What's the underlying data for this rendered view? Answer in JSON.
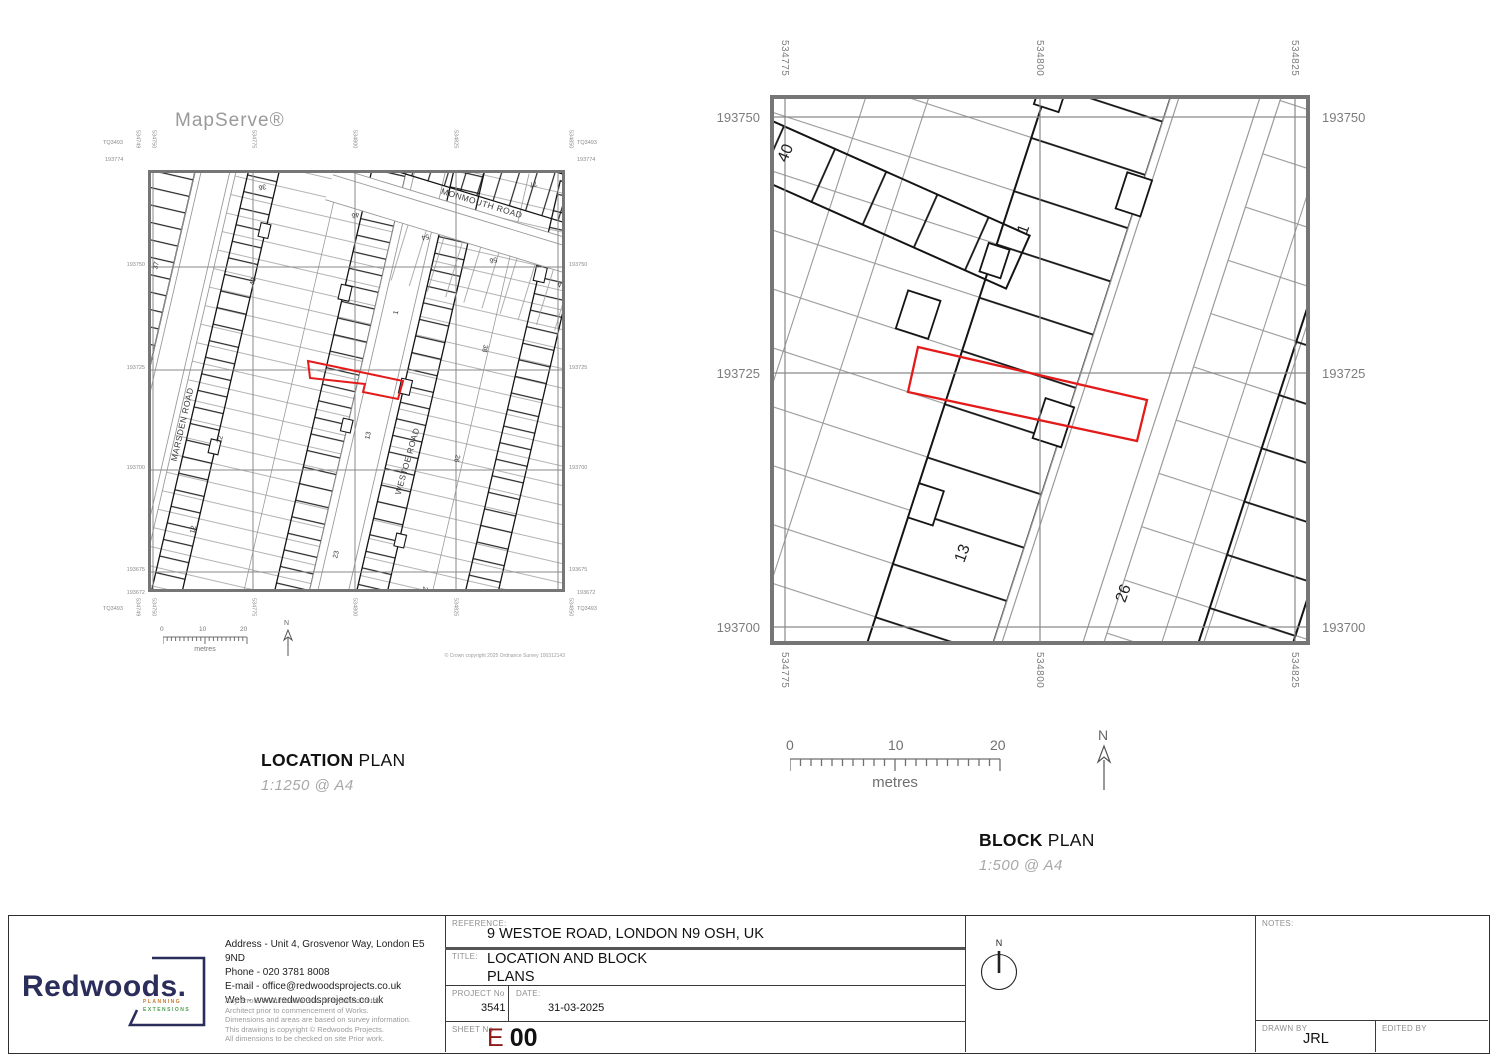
{
  "location_plan": {
    "provider": "MapServe®",
    "caption": {
      "bold": "LOCATION",
      "rest": "PLAN",
      "scale": "1:1250 @ A4"
    },
    "copyright": "© Crown copyright 2025 Ordnance Survey 100312143",
    "scalebar": {
      "zero": "0",
      "ten": "10",
      "twenty": "20",
      "unit": "metres"
    },
    "north": "N",
    "corner_ref": "TQ3493",
    "top_northing": "193774",
    "bottom_northing": "193672",
    "left_easting": "534749",
    "right_easting": "534850",
    "eastings": [
      "534750",
      "534775",
      "534800",
      "534825"
    ],
    "northings": [
      "193750",
      "193725",
      "193700",
      "193675"
    ],
    "roads": {
      "monmouth": "MONMOUTH ROAD",
      "marsden": "MARSDEN ROAD",
      "westoe": "WESTOE ROAD"
    },
    "numbers": {
      "n36": "36",
      "n46": "46",
      "n54": "54",
      "n77": "77",
      "n56": "56",
      "n64": "64",
      "n37": "37",
      "n40": "40",
      "n1": "1",
      "n38": "38",
      "n22": "22",
      "n13": "13",
      "n12": "12",
      "n23": "23",
      "n2": "2",
      "n26": "26"
    }
  },
  "block_plan": {
    "caption": {
      "bold": "BLOCK",
      "rest": "PLAN",
      "scale": "1:500 @ A4"
    },
    "scalebar": {
      "zero": "0",
      "ten": "10",
      "twenty": "20",
      "unit": "metres"
    },
    "north": "N",
    "eastings": [
      "534775",
      "534800",
      "534825"
    ],
    "northings": [
      "193750",
      "193725",
      "193700"
    ],
    "numbers": {
      "n40": "40",
      "n1": "1",
      "n13": "13",
      "n26": "26"
    }
  },
  "title_block": {
    "company": {
      "name": "Redwoods.",
      "tagline_line1": "PLANNING",
      "tagline_line2": "EXTENSIONS",
      "address": "Address - Unit 4, Grosvenor Way, London E5 9ND",
      "phone": "Phone - 020 3781 8008",
      "email": "E-mail - office@redwoodsprojects.co.uk",
      "web": "Web - www.redwoodsprojects.co.uk",
      "disclaimer": [
        "Any errors on Dimensions to be reported to the",
        "Architect prior to commencement of Works.",
        "Dimensions and areas are based on survey information.",
        "This drawing is copyright © Redwoods Projects.",
        "All dimensions to be checked on site Prior work."
      ]
    },
    "reference": {
      "label": "REFERENCE:",
      "value": "9 WESTOE ROAD, LONDON N9 OSH, UK"
    },
    "title": {
      "label": "TITLE:",
      "line1": "LOCATION AND BLOCK",
      "line2": "PLANS"
    },
    "project": {
      "label": "PROJECT No",
      "value": "3541"
    },
    "date": {
      "label": "DATE:",
      "value": "31-03-2025"
    },
    "sheet": {
      "label": "SHEET No",
      "prefix": "E",
      "number": "00"
    },
    "notes": {
      "label": "NOTES:"
    },
    "drawn": {
      "label": "DRAWN BY",
      "value": "JRL"
    },
    "edited": {
      "label": "EDITED BY",
      "value": ""
    },
    "compass_north": "N"
  },
  "colors": {
    "plot_red": "#e31b1b",
    "brand_navy": "#2b2d5b",
    "sheet_red": "#8b1a1a",
    "map_frame_gray": "#767676",
    "muted_gray": "#9a9a9a"
  }
}
